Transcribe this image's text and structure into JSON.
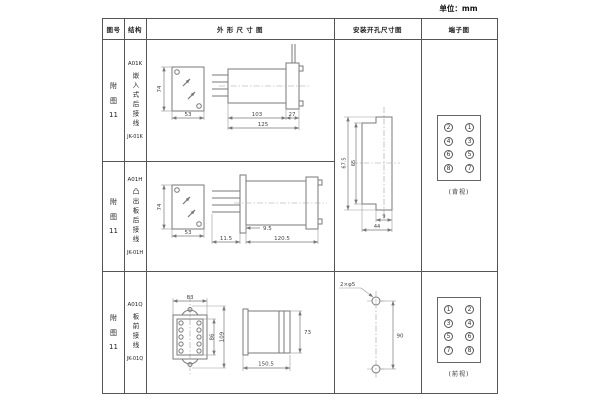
{
  "unit_label": "单位：mm",
  "headers": {
    "figure": "图号",
    "structure": "结构",
    "outline": "外 形 尺 寸 图",
    "mounting": "安装开孔尺寸图",
    "terminal": "端子图"
  },
  "rows": [
    {
      "fig_a": "附",
      "fig_b": "图",
      "fig_num": "11",
      "model": "A01K",
      "desc": "嵌入式后接线",
      "code": "JK-01K",
      "dims": {
        "front_h": "74",
        "front_w": "53",
        "side_body": "103",
        "side_flange": "27",
        "side_total": "125"
      }
    },
    {
      "fig_a": "附",
      "fig_b": "图",
      "fig_num": "11",
      "model": "A01H",
      "desc": "凸出板后接线",
      "code": "JK-01H",
      "dims": {
        "front_h": "74",
        "front_w": "53",
        "side_gap": "9.5",
        "side_pins": "11.5",
        "side_total": "120.5"
      }
    },
    {
      "fig_a": "附",
      "fig_b": "图",
      "fig_num": "11",
      "model": "A01Q",
      "desc": "板前接线",
      "code": "JK-01Q",
      "dims": {
        "front_w": "83",
        "front_inner": "86",
        "front_h": "109",
        "side_h": "73",
        "side_len": "150.5"
      }
    }
  ],
  "mounting12": {
    "outer_h": "67.5",
    "inner_h": "65",
    "slot_w": "9",
    "total_w": "44"
  },
  "mounting3": {
    "pitch": "90",
    "holes": "2×φ5"
  },
  "terminal12": {
    "grid": [
      [
        "2",
        "1"
      ],
      [
        "4",
        "3"
      ],
      [
        "6",
        "5"
      ],
      [
        "8",
        "7"
      ]
    ],
    "view": "(背视)"
  },
  "terminal3": {
    "grid": [
      [
        "1",
        "2"
      ],
      [
        "3",
        "4"
      ],
      [
        "5",
        "6"
      ],
      [
        "7",
        "8"
      ]
    ],
    "view": "(前视)"
  }
}
